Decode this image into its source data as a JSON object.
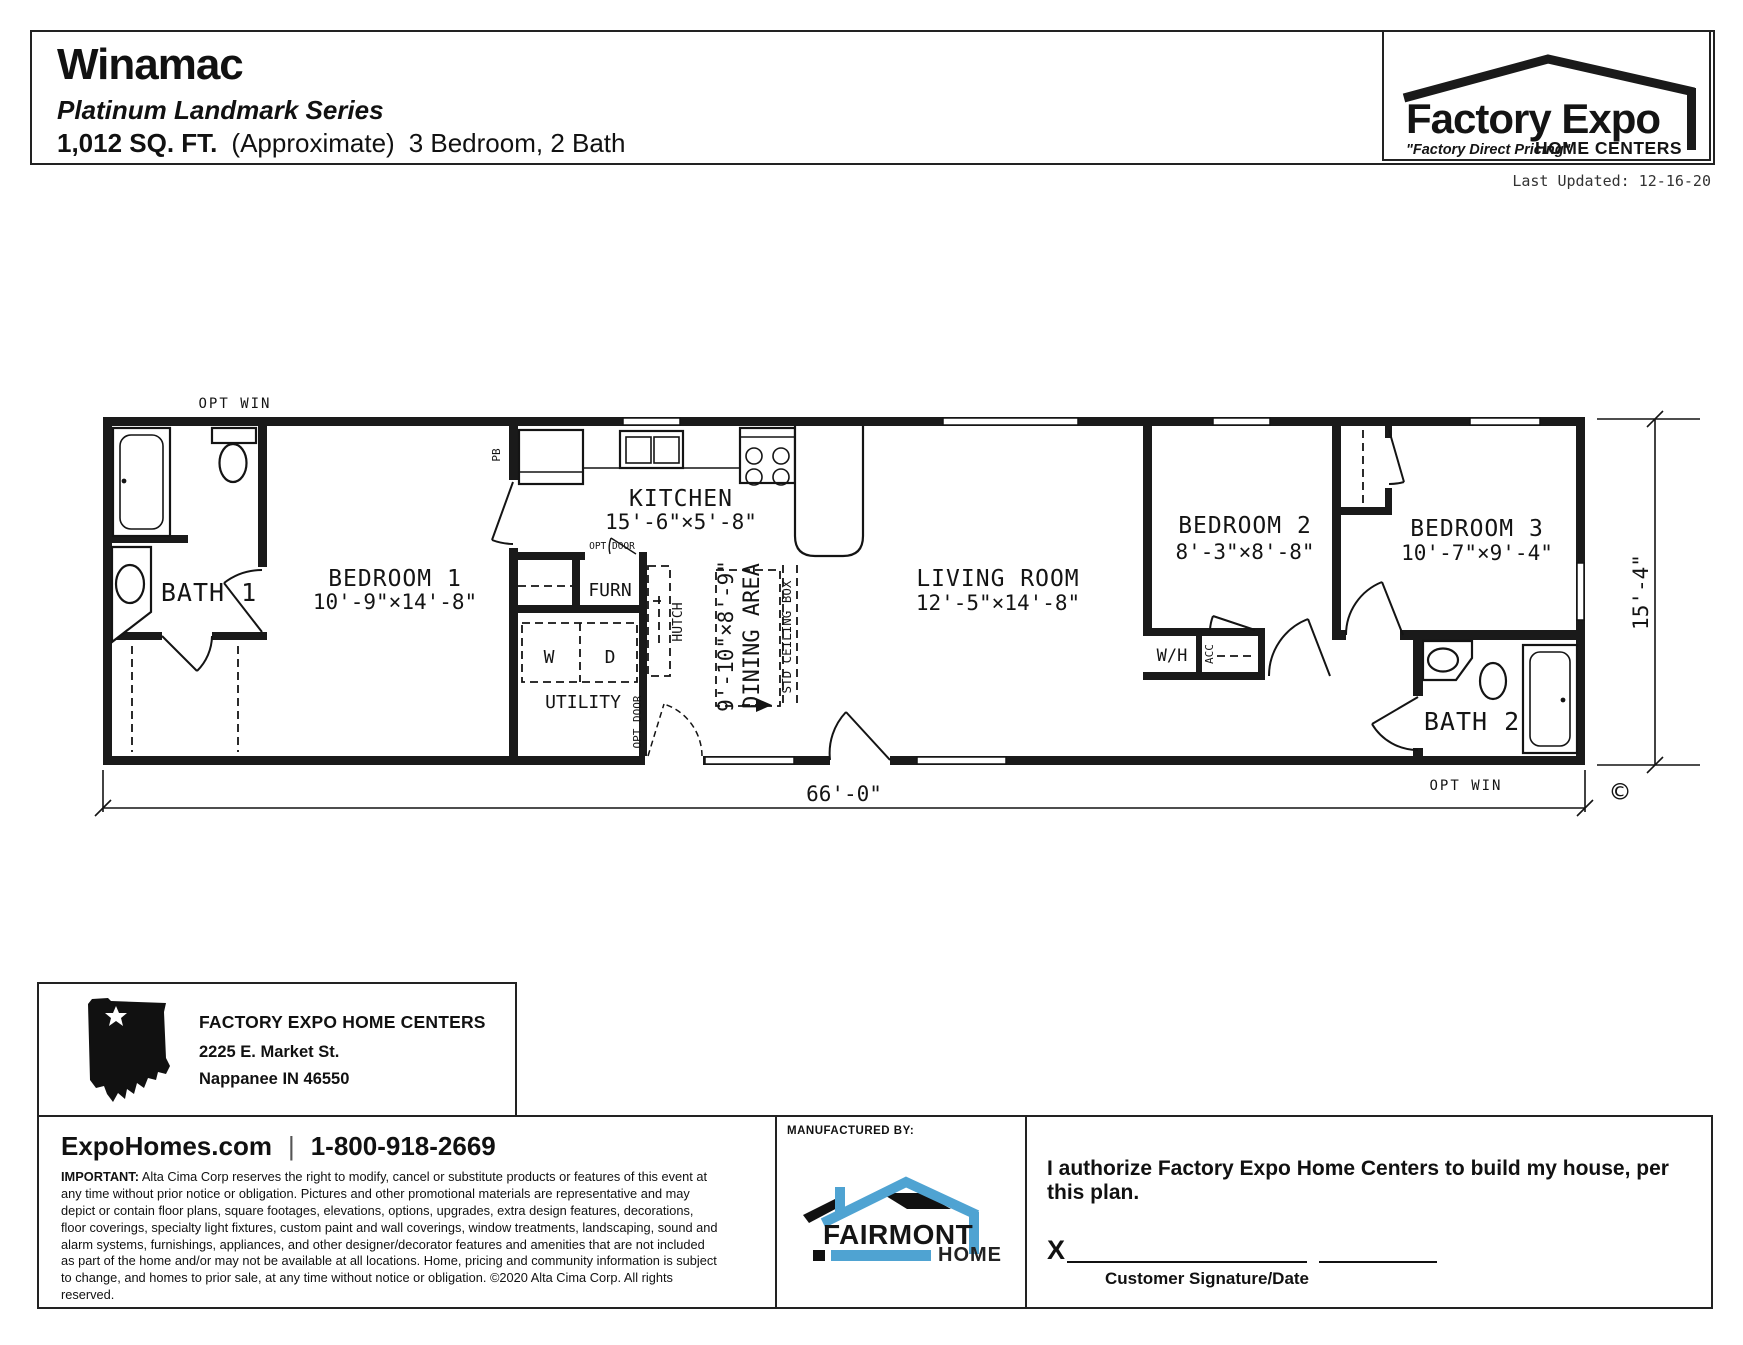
{
  "header": {
    "model_name": "Winamac",
    "series": "Platinum Landmark Series",
    "sqft": "1,012 SQ. FT.",
    "approx": "(Approximate)",
    "beds_baths": "3 Bedroom, 2 Bath",
    "last_updated": "Last Updated: 12-16-20"
  },
  "logo": {
    "name": "Factory Expo",
    "tagline": "\"Factory Direct Pricing\"",
    "subtitle": "HOME CENTERS"
  },
  "plan": {
    "opt_win_top": "OPT WIN",
    "opt_win_bottom": "OPT WIN",
    "pb": "PB",
    "opt_door_top": "OPT DOOR",
    "opt_door_bottom": "OPT DOOR",
    "bath1": "BATH 1",
    "bedroom1": "BEDROOM 1",
    "bedroom1_dims": "10'-9\"×14'-8\"",
    "kitchen": "KITCHEN",
    "kitchen_dims": "15'-6\"×5'-8\"",
    "furn": "FURN",
    "washer": "W",
    "dryer": "D",
    "utility": "UTILITY",
    "hutch": "HUTCH",
    "dining": "DINING AREA",
    "dining_dims": "9'-10\"×8'-9\"",
    "std_ceiling": "STD CEILING BOX",
    "living": "LIVING ROOM",
    "living_dims": "12'-5\"×14'-8\"",
    "wh": "W/H",
    "acc": "ACC",
    "bedroom2": "BEDROOM 2",
    "bedroom2_dims": "8'-3\"×8'-8\"",
    "bedroom3": "BEDROOM 3",
    "bedroom3_dims": "10'-7\"×9'-4\"",
    "bath2": "BATH 2",
    "width_dim": "66'-0\"",
    "height_dim": "15'-4\"",
    "copyright_symbol": "©"
  },
  "dealer": {
    "name": "FACTORY EXPO HOME CENTERS",
    "address1": "2225 E. Market St.",
    "address2": "Nappanee IN 46550"
  },
  "footer": {
    "website": "ExpoHomes.com",
    "phone": "1-800-918-2669",
    "important_label": "IMPORTANT:",
    "legal": " Alta Cima Corp reserves the right to modify, cancel or substitute products or features of this event at any time without prior notice or obligation. Pictures and other promotional materials are representative and may depict or contain floor plans, square footages, elevations, options, upgrades, extra design features, decorations, floor coverings, specialty light fixtures, custom paint and wall coverings, window treatments, landscaping, sound and alarm systems, furnishings, appliances, and other designer/decorator features and amenities that are not included as part of the home and/or may not be available at all locations. Home, pricing and community information is subject to change, and homes to prior sale, at any time without notice or obligation. ©2020 Alta Cima Corp. All rights reserved.",
    "manufactured_by": "MANUFACTURED BY:",
    "fairmont": "FAIRMONT",
    "fairmont_sub": "HOMES",
    "authorization": "I authorize Factory Expo Home Centers to build my house, per this plan.",
    "signature_x": "X",
    "signature_label": "Customer Signature/Date"
  },
  "colors": {
    "accent_blue": "#4FA3D2",
    "ink": "#1a1a1a"
  }
}
